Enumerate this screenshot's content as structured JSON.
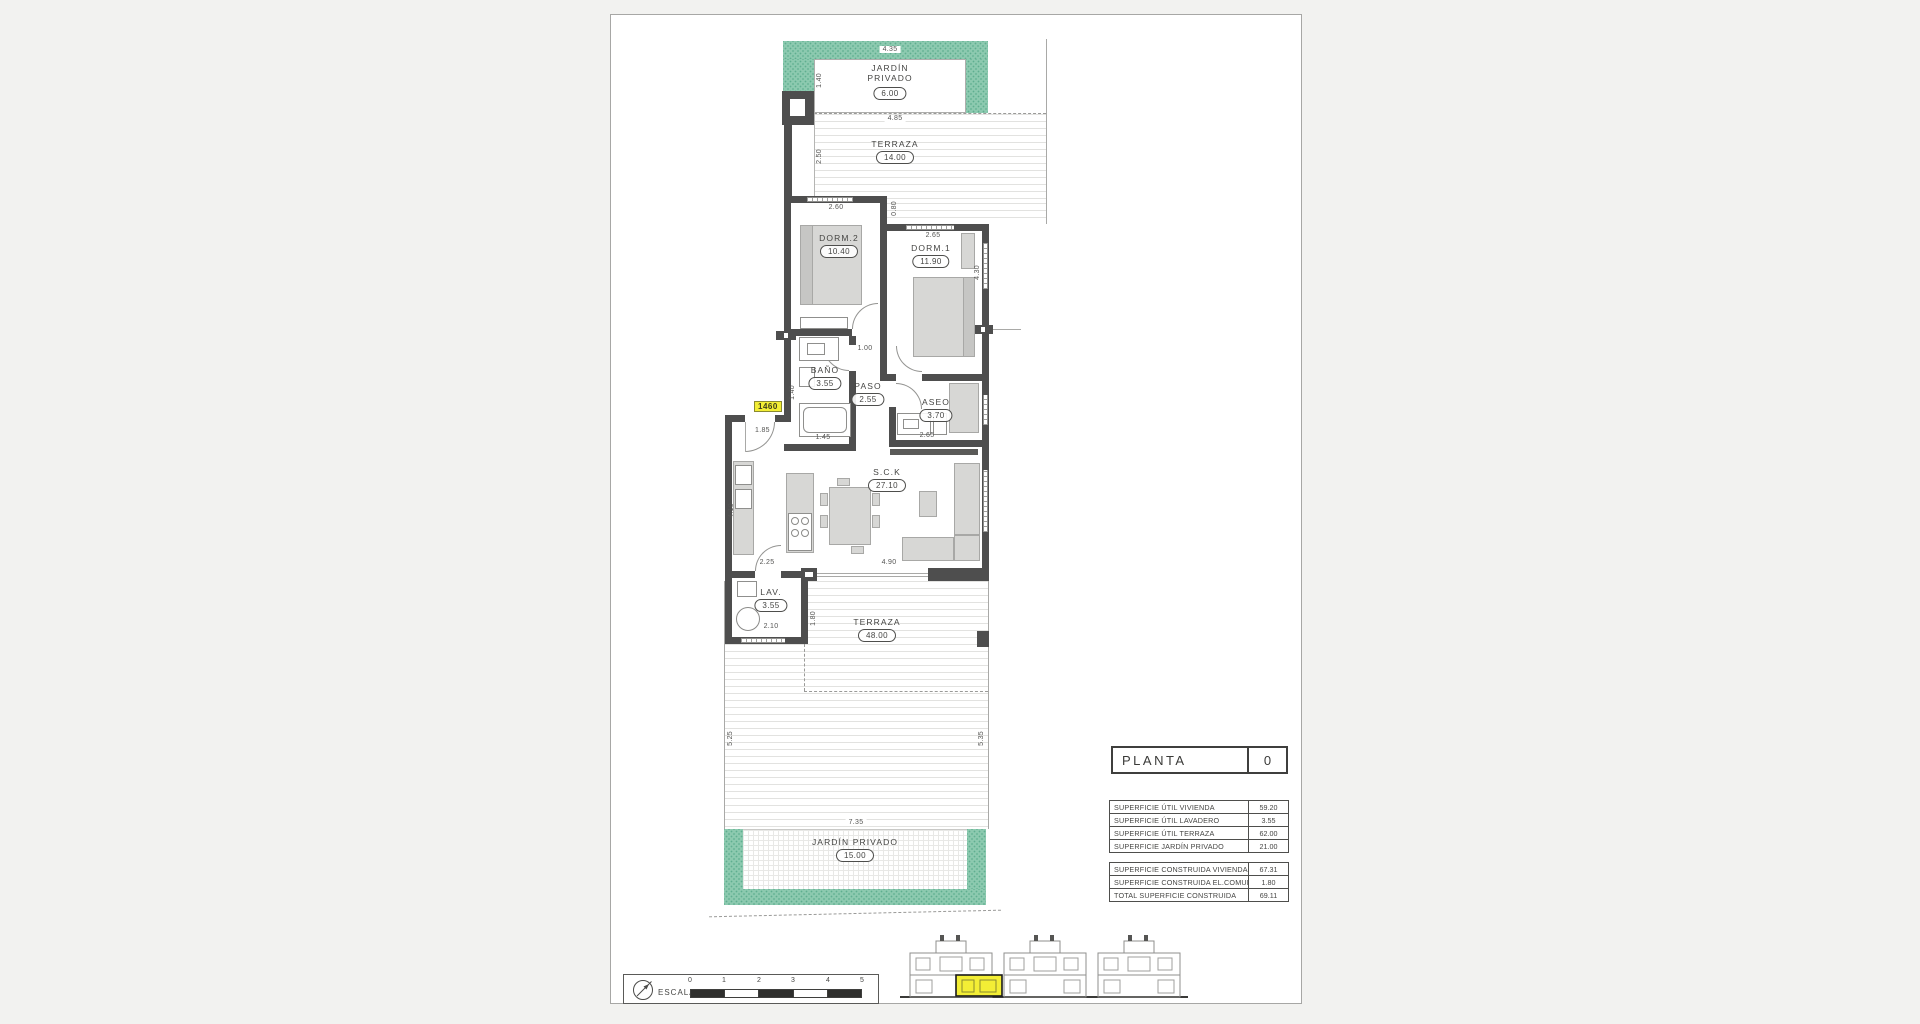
{
  "rooms": {
    "garden_top": {
      "name_line1": "JARDÍN",
      "name_line2": "PRIVADO",
      "area": "6.00"
    },
    "terraza_top": {
      "name": "TERRAZA",
      "area": "14.00"
    },
    "dorm2": {
      "name": "DORM.2",
      "area": "10.40"
    },
    "dorm1": {
      "name": "DORM.1",
      "area": "11.90"
    },
    "bano": {
      "name": "BAÑO",
      "area": "3.55"
    },
    "paso": {
      "name": "PASO",
      "area": "2.55"
    },
    "aseo": {
      "name": "ASEO",
      "area": "3.70"
    },
    "sck": {
      "name": "S.C.K",
      "area": "27.10"
    },
    "lav": {
      "name": "LAV.",
      "area": "3.55"
    },
    "terraza_main": {
      "name": "TERRAZA",
      "area": "48.00"
    },
    "garden_bottom": {
      "name": "JARDÍN PRIVADO",
      "area": "15.00"
    }
  },
  "dims": {
    "garden_top_width": "4.35",
    "garden_top_depth": "1.40",
    "terraza_top_width": "4.85",
    "terraza_top_depth": "2.50",
    "dorm2_width": "2.60",
    "wall_step": "0.80",
    "dorm1_width": "2.65",
    "dorm1_depth": "4.30",
    "paso_width": "1.00",
    "bano_side": "1.40",
    "bano_width": "1.45",
    "entry_width": "1.85",
    "aseo_width": "2.65",
    "kitchen_depth": "4.10",
    "kitchen_width": "2.25",
    "sck_width": "4.90",
    "lav_width": "2.10",
    "lav_side": "1.80",
    "terraza_left": "5.25",
    "terraza_right": "5.35",
    "garden_bottom_width": "7.35"
  },
  "unit_tag": "1460",
  "planta": {
    "label": "PLANTA",
    "value": "0"
  },
  "area_tables": {
    "util": [
      {
        "label": "SUPERFICIE ÚTIL VIVIENDA",
        "value": "59.20"
      },
      {
        "label": "SUPERFICIE ÚTIL LAVADERO",
        "value": "3.55"
      },
      {
        "label": "SUPERFICIE ÚTIL TERRAZA",
        "value": "62.00"
      },
      {
        "label": "SUPERFICIE JARDÍN PRIVADO",
        "value": "21.00"
      }
    ],
    "construida": [
      {
        "label": "SUPERFICIE CONSTRUIDA VIVIENDA",
        "value": "67.31"
      },
      {
        "label": "SUPERFICIE CONSTRUIDA EL.COMUNES",
        "value": "1.80"
      },
      {
        "label": "TOTAL SUPERFICIE CONSTRUIDA",
        "value": "69.11"
      }
    ]
  },
  "scale_bar": {
    "label": "ESCALA :",
    "ticks": [
      "0",
      "1",
      "2",
      "3",
      "4",
      "5"
    ]
  },
  "colors": {
    "garden_green": "#8cc9af",
    "wall": "#4e4e4e",
    "highlight_yellow": "#f3ee35",
    "furniture_gray": "#d7d7d5"
  }
}
